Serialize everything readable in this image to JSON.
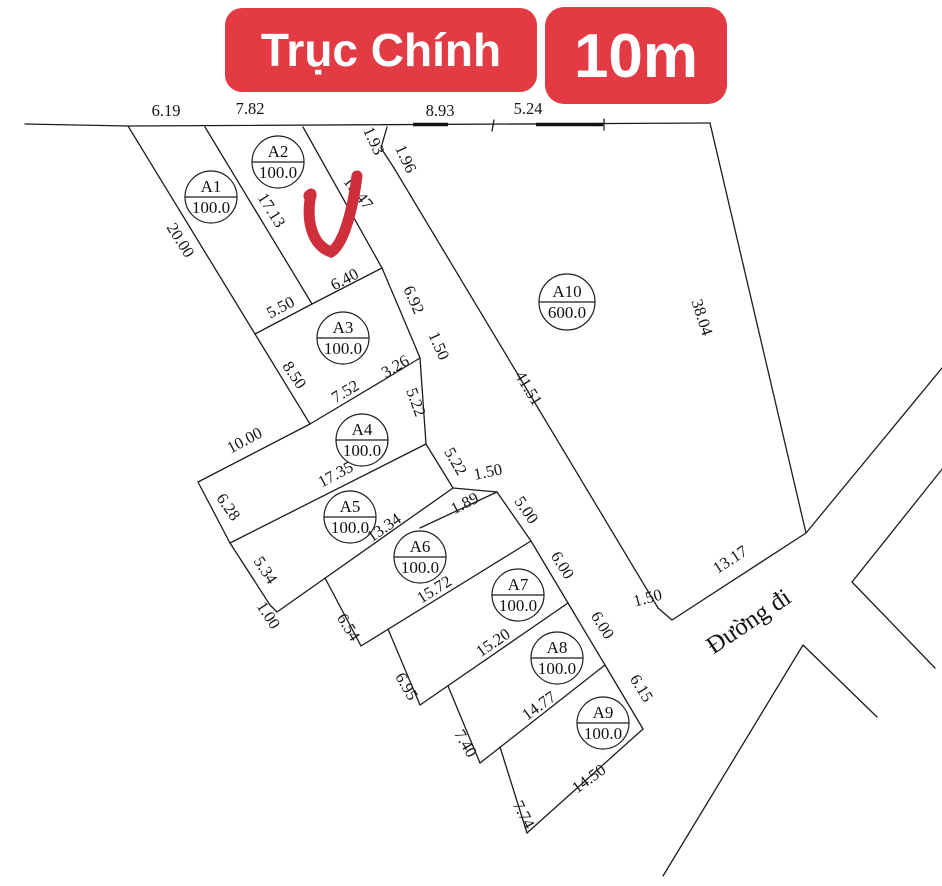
{
  "banner": {
    "main_road_label": "Trục Chính",
    "main_road_width": "10m"
  },
  "road": {
    "name": "Đường đi"
  },
  "colors": {
    "banner_red": "#E23B43",
    "checkmark_red": "#CE2F3A",
    "line_color": "#1C1C1C"
  },
  "plots": [
    {
      "id": "A1",
      "area": "100.0"
    },
    {
      "id": "A2",
      "area": "100.0"
    },
    {
      "id": "A3",
      "area": "100.0"
    },
    {
      "id": "A4",
      "area": "100.0"
    },
    {
      "id": "A5",
      "area": "100.0"
    },
    {
      "id": "A6",
      "area": "100.0"
    },
    {
      "id": "A7",
      "area": "100.0"
    },
    {
      "id": "A8",
      "area": "100.0"
    },
    {
      "id": "A9",
      "area": "100.0"
    },
    {
      "id": "A10",
      "area": "600.0"
    }
  ],
  "dims": [
    {
      "t": "6.19"
    },
    {
      "t": "7.82"
    },
    {
      "t": "8.93"
    },
    {
      "t": "5.24"
    },
    {
      "t": "1.93"
    },
    {
      "t": "1.96"
    },
    {
      "t": "20.00"
    },
    {
      "t": "17.13"
    },
    {
      "t": "13.47"
    },
    {
      "t": "5.50"
    },
    {
      "t": "6.40"
    },
    {
      "t": "6.92"
    },
    {
      "t": "1.50"
    },
    {
      "t": "3.26"
    },
    {
      "t": "7.52"
    },
    {
      "t": "8.50"
    },
    {
      "t": "10.00"
    },
    {
      "t": "6.28"
    },
    {
      "t": "17.35"
    },
    {
      "t": "5.22"
    },
    {
      "t": "5.22"
    },
    {
      "t": "5.34"
    },
    {
      "t": "1.00"
    },
    {
      "t": "13.34"
    },
    {
      "t": "1.50"
    },
    {
      "t": "1.89"
    },
    {
      "t": "5.00"
    },
    {
      "t": "6.54"
    },
    {
      "t": "15.72"
    },
    {
      "t": "6.95"
    },
    {
      "t": "15.20"
    },
    {
      "t": "6.00"
    },
    {
      "t": "6.00"
    },
    {
      "t": "7.40"
    },
    {
      "t": "14.77"
    },
    {
      "t": "7.74"
    },
    {
      "t": "14.50"
    },
    {
      "t": "6.15"
    },
    {
      "t": "38.04"
    },
    {
      "t": "41.51"
    },
    {
      "t": "13.17"
    },
    {
      "t": "1.50"
    }
  ]
}
